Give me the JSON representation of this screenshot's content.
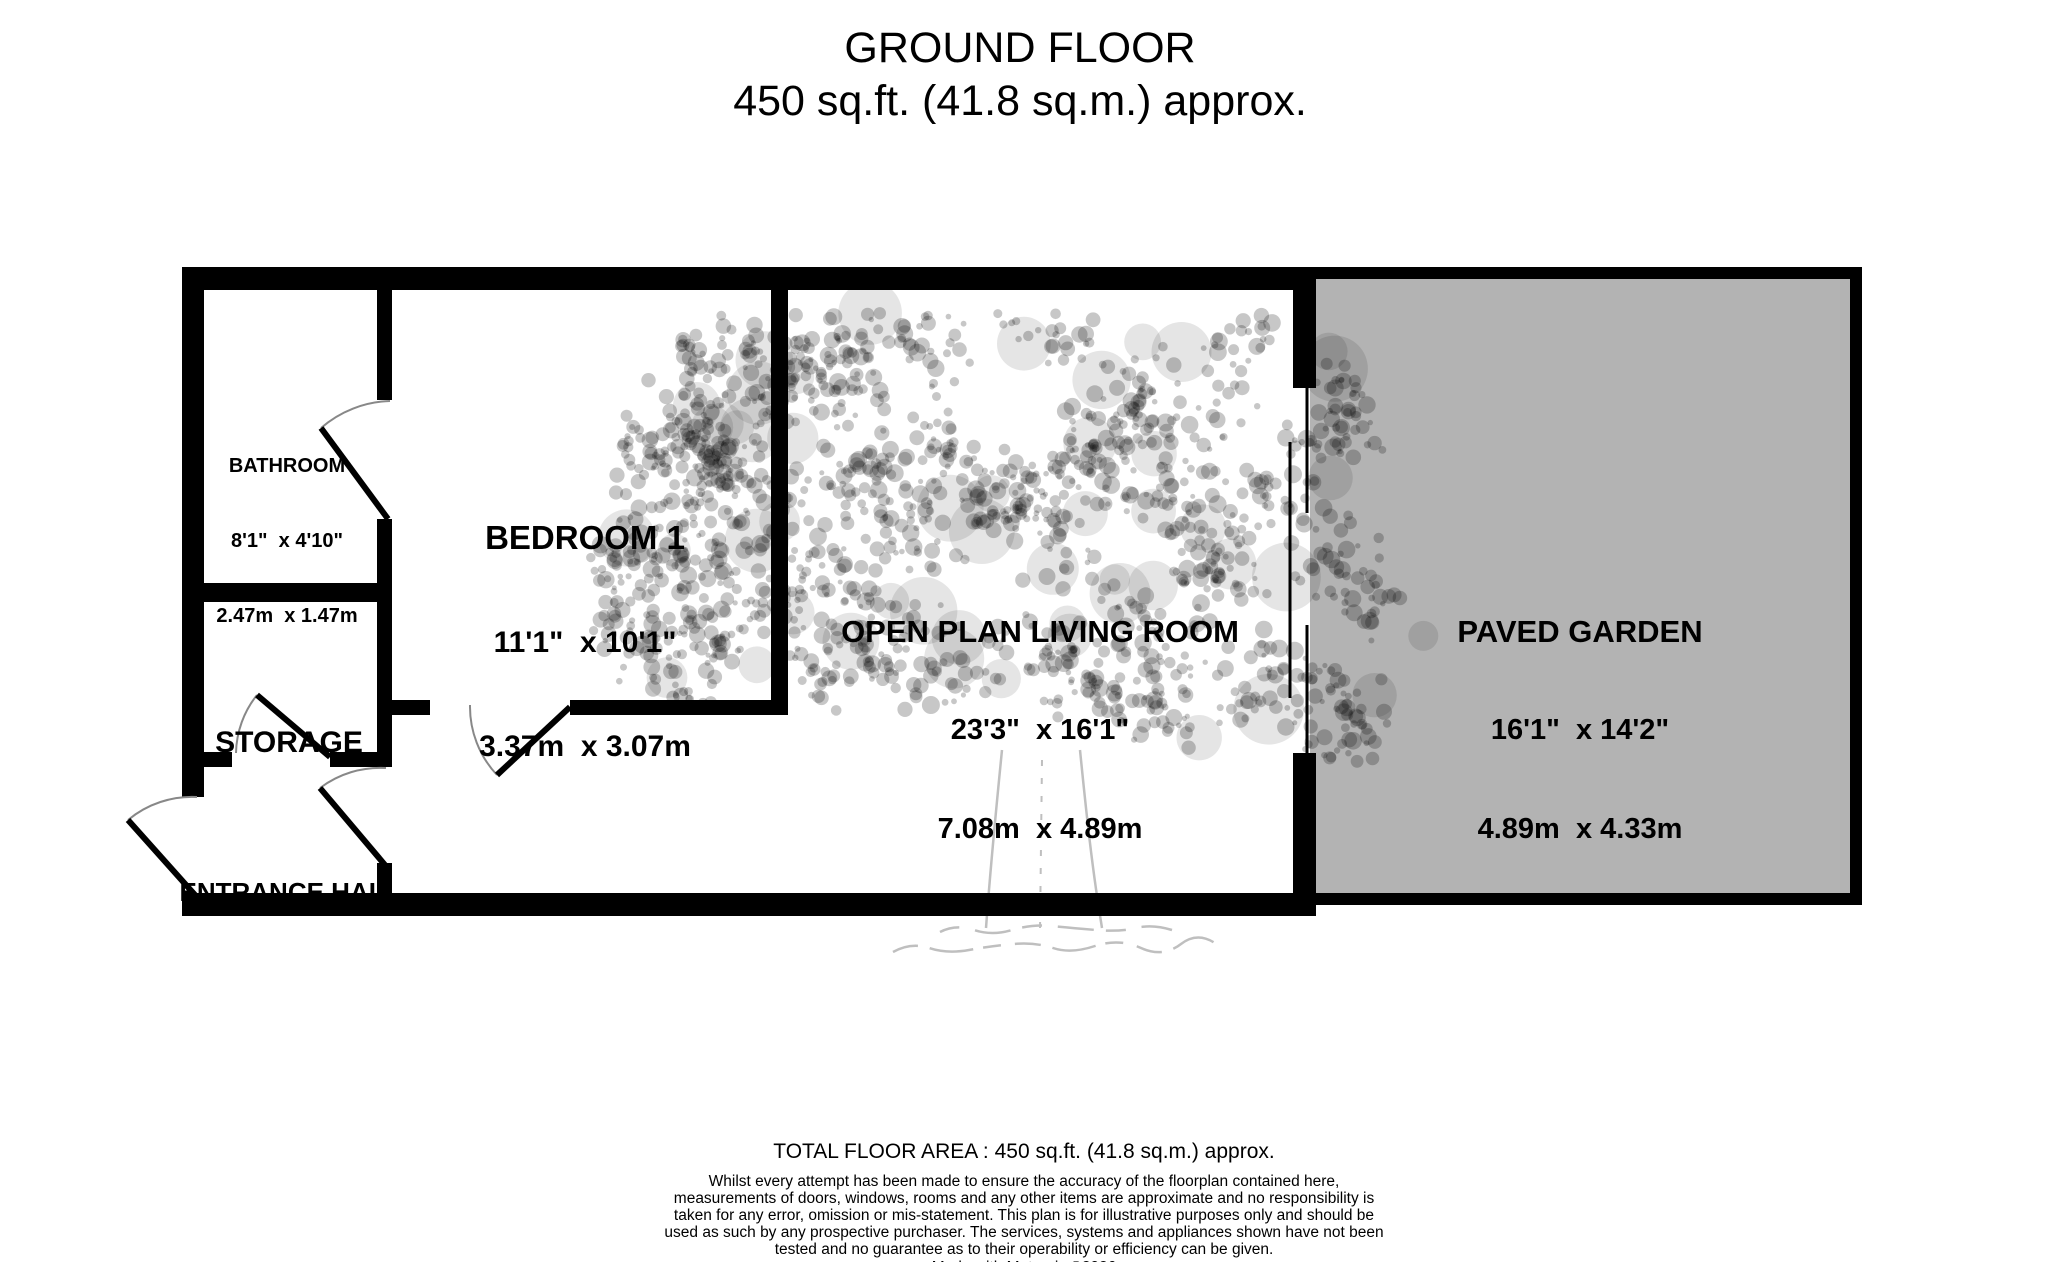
{
  "title": {
    "line1": "GROUND FLOOR",
    "line2": "450 sq.ft. (41.8 sq.m.) approx."
  },
  "rooms": {
    "bathroom": {
      "name": "BATHROOM",
      "imperial": "8'1\"  x 4'10\"",
      "metric": "2.47m  x 1.47m"
    },
    "bedroom1": {
      "name": "BEDROOM 1",
      "imperial": "11'1\"  x 10'1\"",
      "metric": "3.37m  x 3.07m"
    },
    "storage": {
      "name": "STORAGE"
    },
    "entrance_hall": {
      "name": "ENTRANCE HALL"
    },
    "living_room": {
      "name": "OPEN PLAN LIVING ROOM",
      "imperial": "23'3\"  x 16'1\"",
      "metric": "7.08m  x 4.89m"
    },
    "paved_garden": {
      "name": "PAVED GARDEN",
      "imperial": "16'1\"  x 14'2\"",
      "metric": "4.89m  x 4.33m"
    }
  },
  "footer": {
    "total_area": "TOTAL FLOOR AREA : 450 sq.ft. (41.8 sq.m.) approx.",
    "disclaimer": "Whilst every attempt has been made to ensure the accuracy of the floorplan contained here, measurements of doors, windows, rooms and any other items are approximate and no responsibility is taken for any error, omission or mis-statement. This plan is for illustrative purposes only and should be used as such by any prospective purchaser. The services, systems and appliances shown have not been tested and no guarantee as to their operability or efficiency can be given.",
    "credit": "Made with Metropix ©2026"
  },
  "colors": {
    "wall": "#000000",
    "floor": "#ffffff",
    "garden_fill": "#b3b3b3",
    "tree_tint": "rgba(0,0,0,0.22)",
    "door_arc": "#888888"
  }
}
